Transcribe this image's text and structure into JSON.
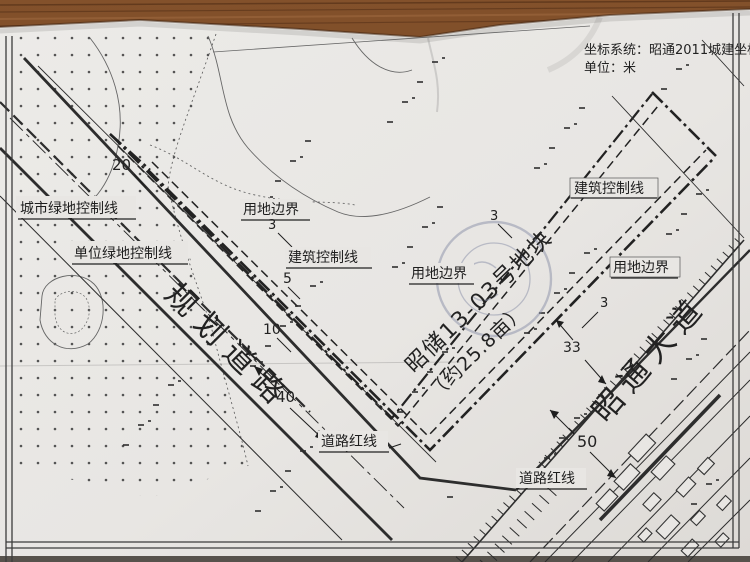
{
  "coordinate_note": {
    "line1": "坐标系统：昭通2011城建坐标系",
    "line2": "单位：米"
  },
  "labels": {
    "city_green_control_line": "城市绿地控制线",
    "unit_green_control_line": "单位绿地控制线",
    "land_use_boundary": "用地边界",
    "building_control_line": "建筑控制线",
    "road_red_line": "道路红线",
    "planned_road": "规划道路",
    "avenue": "昭通大道",
    "parcel_name": "昭储13-03号地块",
    "parcel_area": "（约25.8亩）"
  },
  "dimensions": {
    "green_belt_width": "20",
    "setback_a": "3",
    "setback_b": "5",
    "setback_c": "10",
    "planned_road_width": "40",
    "setback_d": "3",
    "setback_e": "3",
    "avenue_width_a": "33",
    "avenue_width_b": "50"
  },
  "colors": {
    "paper": "#e8e6e3",
    "ink": "#2d2d2d",
    "wood": "#7a4a26",
    "stamp": "#8a90a8"
  }
}
